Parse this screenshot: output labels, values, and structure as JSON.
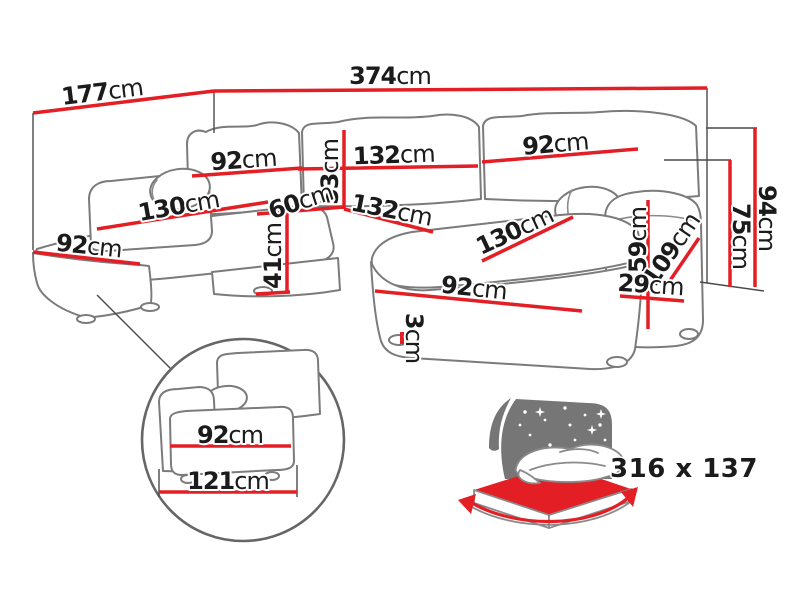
{
  "colors": {
    "dimension": "#e31e24",
    "outline": "#7b7b7b",
    "icon_gray": "#767676",
    "text": "#1b1b1b",
    "bed_label": "#6f6f6f"
  },
  "dims": [
    {
      "name": "back-depth-left",
      "value": "177",
      "unit": "cm"
    },
    {
      "name": "total-width",
      "value": "374",
      "unit": "cm"
    },
    {
      "name": "back-cushion-left-width",
      "value": "92",
      "unit": "cm"
    },
    {
      "name": "back-cushion-middle-width",
      "value": "132",
      "unit": "cm"
    },
    {
      "name": "back-cushion-height",
      "value": "53",
      "unit": "cm"
    },
    {
      "name": "back-cushion-right-width",
      "value": "92",
      "unit": "cm"
    },
    {
      "name": "left-chaise-length",
      "value": "130",
      "unit": "cm"
    },
    {
      "name": "left-chaise-width",
      "value": "92",
      "unit": "cm"
    },
    {
      "name": "corner-seat-width",
      "value": "60",
      "unit": "cm"
    },
    {
      "name": "seat-width",
      "value": "132",
      "unit": "cm"
    },
    {
      "name": "seat-height",
      "value": "41",
      "unit": "cm"
    },
    {
      "name": "right-chaise-length",
      "value": "130",
      "unit": "cm"
    },
    {
      "name": "right-chaise-width",
      "value": "92",
      "unit": "cm"
    },
    {
      "name": "leg-height",
      "value": "3",
      "unit": "cm"
    },
    {
      "name": "armrest-height",
      "value": "59",
      "unit": "cm"
    },
    {
      "name": "armrest-depth",
      "value": "109",
      "unit": "cm"
    },
    {
      "name": "armrest-width",
      "value": "29",
      "unit": "cm"
    },
    {
      "name": "backrest-height",
      "value": "75",
      "unit": "cm"
    },
    {
      "name": "total-height",
      "value": "94",
      "unit": "cm"
    },
    {
      "name": "detail-seat-width",
      "value": "92",
      "unit": "cm"
    },
    {
      "name": "detail-total-width",
      "value": "121",
      "unit": "cm"
    }
  ],
  "sleeping_area": {
    "label": "316 x 137"
  }
}
